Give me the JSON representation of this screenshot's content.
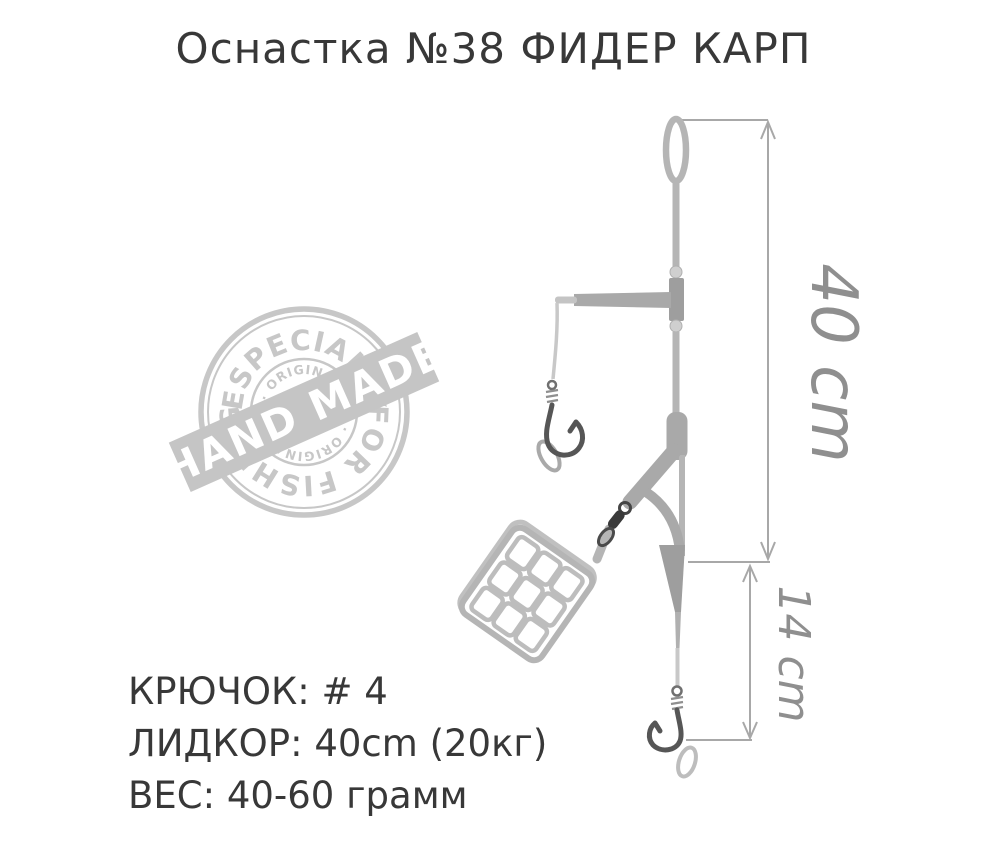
{
  "title": "Оснастка №38 ФИДЕР КАРП",
  "stamp": {
    "ring_top_text": "ESPECIALLY",
    "ring_bottom_text": "FOR FISHING",
    "inner_top_text": "· ORIGINAL ·",
    "inner_bottom_text": "· ORIGINAL ·",
    "banner_text": "HAND MADE",
    "color": "#c7c7c7"
  },
  "dimensions": {
    "overall": {
      "label": "40 cm"
    },
    "tail": {
      "label": "14 cm"
    }
  },
  "specs": {
    "lines": [
      "КРЮЧОК: # 4",
      "ЛИДКОР: 40cm (20кг)",
      "ВЕС: 40-60 грамм"
    ]
  },
  "colors": {
    "line_light": "#b5b5b5",
    "line_mid": "#a9a9a9",
    "connector": "#9e9e9e",
    "hook_dark": "#565656",
    "swivel_dark": "#3a3a3a",
    "dimension_lines": "#a8a8a8",
    "dimension_text": "#8f8f8f",
    "text": "#383838",
    "stamp": "#c7c7c7"
  }
}
